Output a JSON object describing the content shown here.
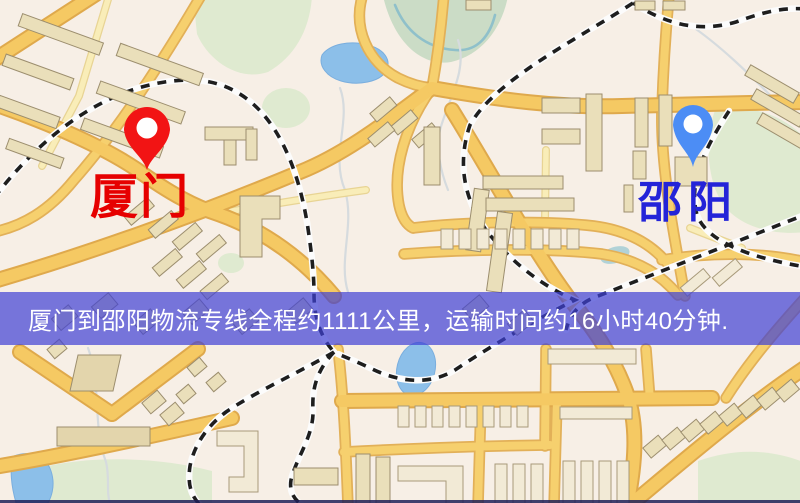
{
  "map": {
    "origin": {
      "label": "厦门",
      "label_color": "#e60000",
      "pin_color": "#f21414"
    },
    "destination": {
      "label": "邵阳",
      "label_color": "#2424d8",
      "pin_color": "#4c8df5"
    }
  },
  "banner": {
    "text": "厦门到邵阳物流专线全程约1111公里，运输时间约16小时40分钟.",
    "background": "#3e40d4",
    "text_color": "#ffffff",
    "distance": "约1111公里",
    "duration": "约16小时40分钟"
  },
  "palette": {
    "map_background": "#f7efe6",
    "road_major": "#f5c963",
    "road_casing": "#dfa94c",
    "road_minor": "#f9edb8",
    "park": "#dfead0",
    "water": "#8cbfe9",
    "railway": "#1e1e1e",
    "building": "#eadfba"
  }
}
